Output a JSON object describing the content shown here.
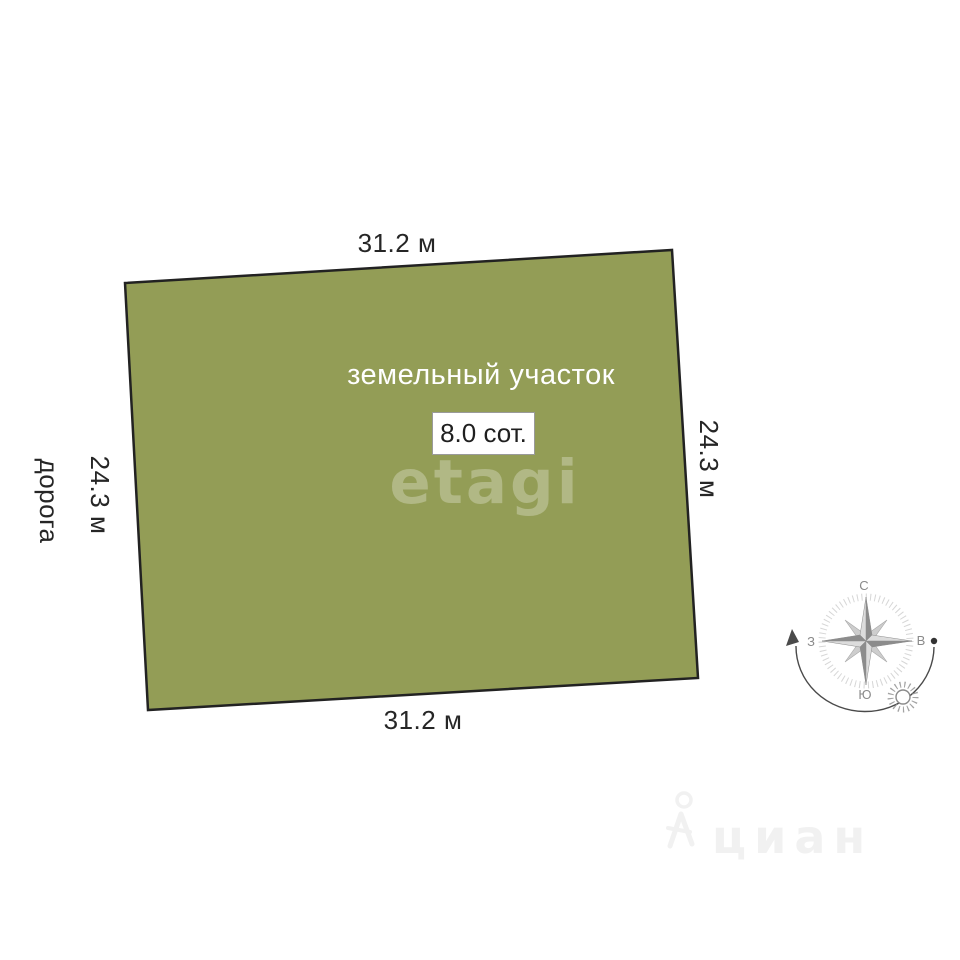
{
  "plot": {
    "name_label": "земельный участок",
    "area_label": "8.0 сот.",
    "fill_color": "#939d56",
    "border_color": "#222222",
    "dim_top": "31.2 м",
    "dim_bottom": "31.2 м",
    "dim_left": "24.3 м",
    "dim_right": "24.3 м",
    "road_label": "дорога"
  },
  "compass": {
    "north_label": "С",
    "east_label": "В",
    "south_label": "Ю",
    "west_label": "З"
  },
  "watermarks": {
    "etagi_text": "etagi",
    "cian_text": "циан"
  }
}
